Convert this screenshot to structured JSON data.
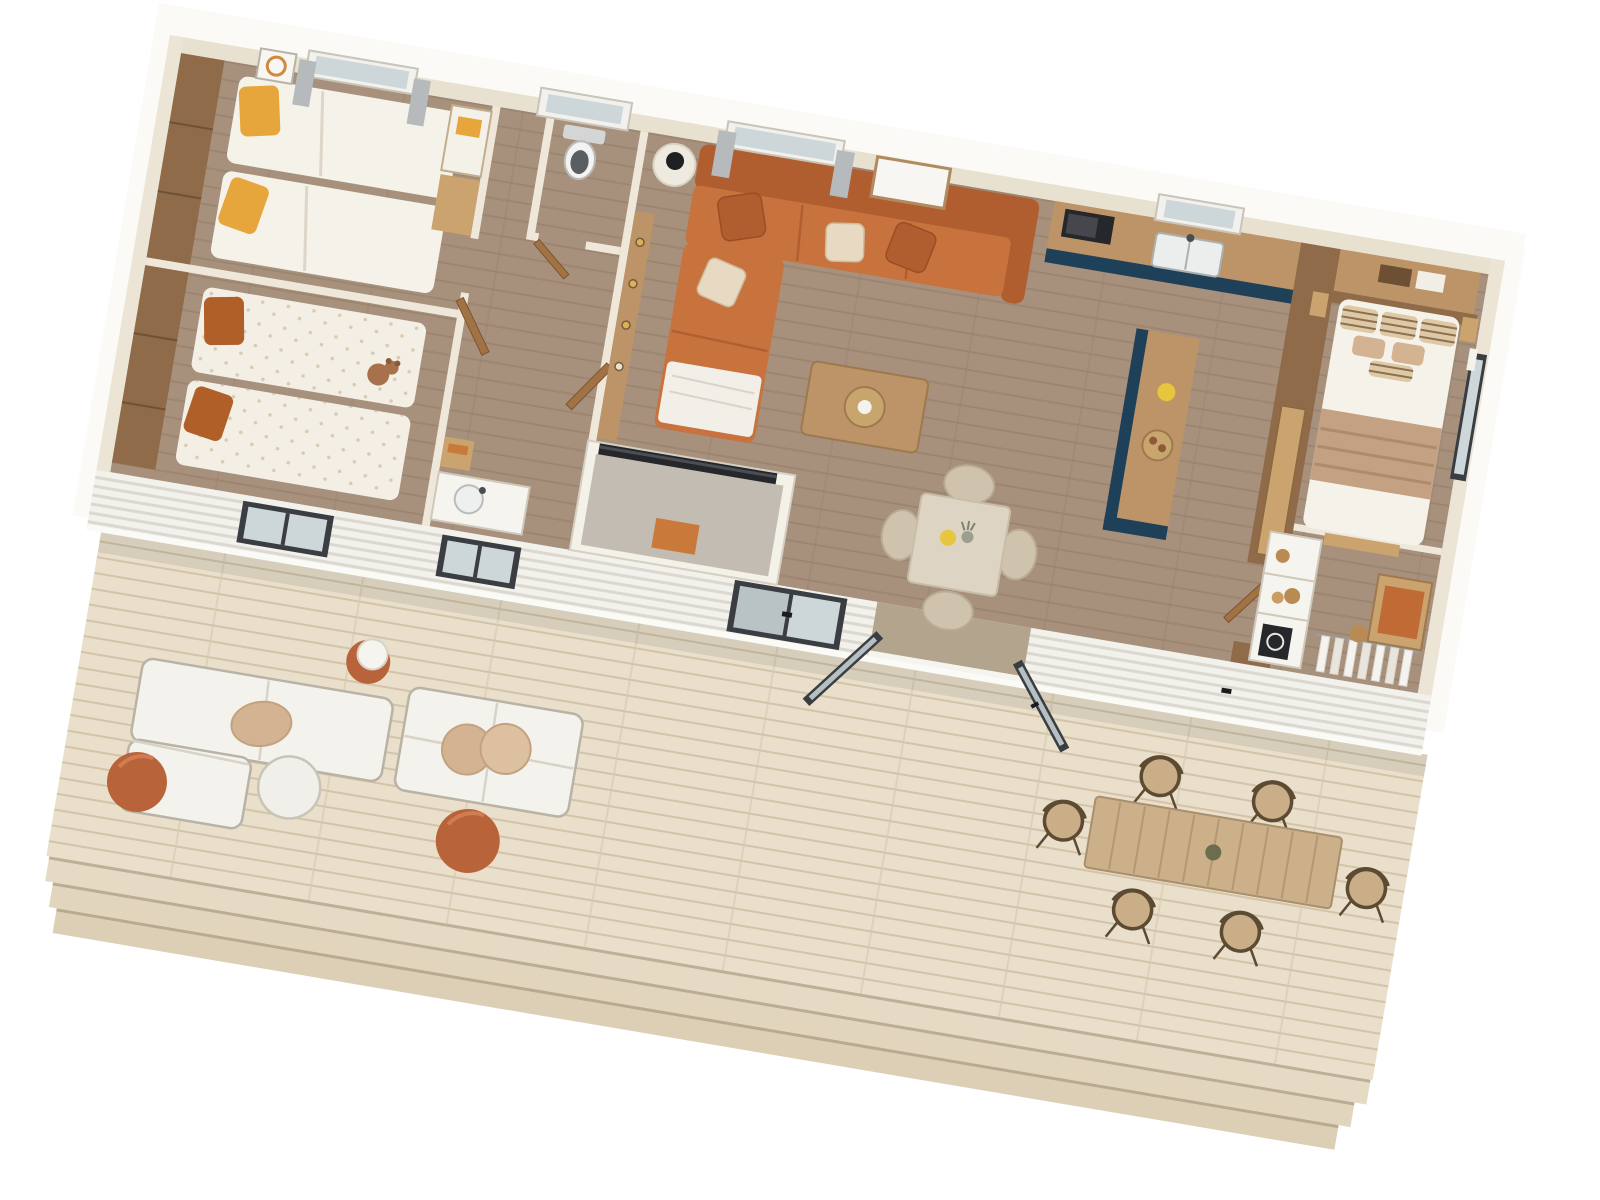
{
  "scene": {
    "title": "3D top-down floor plan render of a mobile home with wooden deck terrace",
    "rotation_deg": 9.6,
    "rooms": [
      {
        "id": "twin-bedroom-1",
        "label": "Twin bedroom 1",
        "furniture": [
          "two single beds",
          "yellow pillows",
          "wall mirror",
          "wardrobe with yellow towel",
          "curtained window"
        ]
      },
      {
        "id": "twin-bedroom-2",
        "label": "Twin bedroom 2",
        "furniture": [
          "two single beds",
          "orange pillows",
          "dotted duvets",
          "teddy bear",
          "facade window"
        ]
      },
      {
        "id": "wc",
        "label": "WC",
        "furniture": [
          "toilet",
          "skylight window",
          "door ajar"
        ]
      },
      {
        "id": "bathroom",
        "label": "Shower room",
        "furniture": [
          "vanity with round sink",
          "wood shelf",
          "shower / storage cubicle"
        ]
      },
      {
        "id": "living-room",
        "label": "Living room",
        "furniture": [
          "orange corner sofa",
          "beige and orange cushions",
          "white throw",
          "side table with black lamp",
          "media console",
          "TV",
          "coffee table with tray",
          "curtained window",
          "wall picture frame"
        ]
      },
      {
        "id": "dining-area",
        "label": "Dining area",
        "furniture": [
          "square table",
          "four beige chairs",
          "yellow candle",
          "flower vase"
        ]
      },
      {
        "id": "kitchen",
        "label": "Kitchen",
        "furniture": [
          "wood counter",
          "microwave",
          "sink under window",
          "navy base cabinets",
          "island with yellow pitcher and breakfast tray"
        ]
      },
      {
        "id": "master-bedroom",
        "label": "Master bedroom",
        "furniture": [
          "double bed",
          "striped pillows",
          "tan blanket",
          "overhead cabinets",
          "nightstands",
          "side-wall window"
        ]
      },
      {
        "id": "dressing",
        "label": "Dressing / closet",
        "furniture": [
          "white cubby shelf",
          "speaker",
          "desk with orange pad",
          "stool",
          "hanging rail with clothes",
          "sliding wardrobe door"
        ]
      },
      {
        "id": "deck",
        "label": "Deck terrace",
        "furniture": [
          "two white lounge sofas",
          "tan cushions",
          "round white table",
          "terracotta stool with ball lamp",
          "two terracotta poufs",
          "plank dining table",
          "six wicker chairs",
          "three steps"
        ]
      }
    ],
    "exterior": {
      "siding": "white horizontal clapboard",
      "openings": [
        "bedroom window",
        "bathroom window",
        "sliding glass window",
        "open double glass doors",
        "door handles"
      ]
    }
  },
  "palette": {
    "page_bg": "#ffffff",
    "fascia": "#fbfaf7",
    "wall_cream": "#e9e1d0",
    "wall_partition": "#efe8da",
    "floor_wood": "#a8917c",
    "deck_wood": "#e9dfca",
    "siding": "#f3f1ec",
    "wood": "#bd9468",
    "wood_light": "#caa36f",
    "wood_dark": "#8f6b49",
    "wood_door": "#a07244",
    "navy": "#1f4059",
    "sofa_orange": "#c8723e",
    "sofa_orange_deep": "#b05d2f",
    "cushion_beige": "#e7d9c2",
    "duvet_white": "#f5f2ea",
    "dotted_duvet": "#f3efe4",
    "pillow_yellow": "#e6a63c",
    "pillow_orange": "#b15f28",
    "blanket_tan": "#c5a183",
    "glass": "#cdd7da",
    "frame_dark": "#3a3d41",
    "curtain_gray": "#b7babc",
    "terracotta": "#b9633b",
    "wicker_brown": "#5d4a33",
    "seat_tan": "#d3b392",
    "white_furniture": "#f4f2ec",
    "appliance_dark": "#26272b",
    "table_beige": "#ded4c3",
    "teddy_brown": "#a9714b",
    "tray_wood": "#c9a56e",
    "candle_yellow": "#e7c53e",
    "step_shadow": "#8d7c62"
  }
}
